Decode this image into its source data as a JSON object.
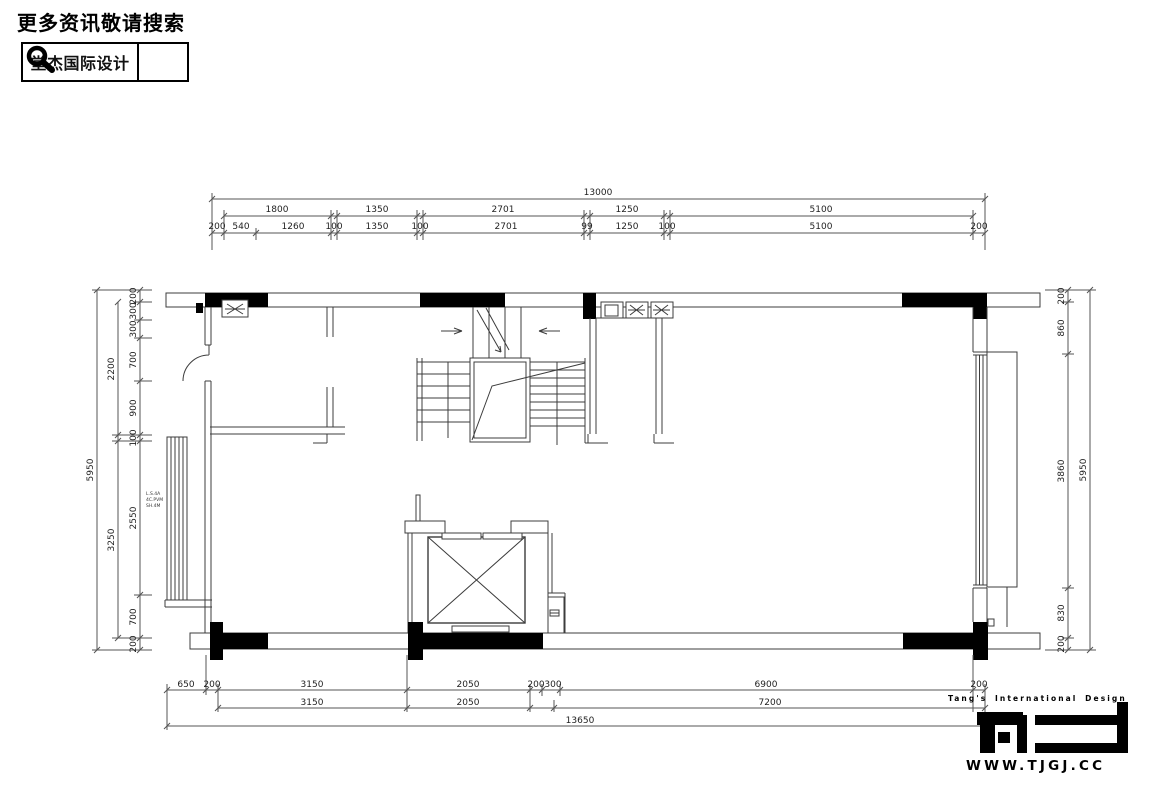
{
  "header": {
    "title": "更多资讯敬请搜索",
    "logo_text": "堂杰国际设计",
    "search_icon": "magnifier-icon"
  },
  "footer": {
    "tagline": "Tang's International Design",
    "logo_name": "TJID logo",
    "website": "WWW.TJGJ.CC"
  },
  "plan": {
    "dims": {
      "top_total": "13000",
      "top_mid": [
        "1800",
        "1350",
        "2701",
        "1250",
        "5100"
      ],
      "top_inner": [
        "200",
        "540",
        "1260",
        "100",
        "1350",
        "100",
        "2701",
        "99",
        "1250",
        "100",
        "5100",
        "200"
      ],
      "left_total": "5950",
      "left_mid": [
        "2200",
        "3250"
      ],
      "left_inner": [
        "200",
        "300",
        "300",
        "700",
        "900",
        "100",
        "2550",
        "700",
        "200"
      ],
      "right_total": "5950",
      "right_inner": [
        "200",
        "860",
        "3860",
        "830",
        "200"
      ],
      "bottom_inner": [
        "650",
        "200",
        "3150",
        "2050",
        "200",
        "300",
        "6900",
        "200"
      ],
      "bottom_mid": [
        "3150",
        "2050",
        "7200"
      ],
      "bottom_total": "13650"
    },
    "notes": [
      "L.S.4A",
      "4C.PVM",
      "SH.4M"
    ]
  },
  "colors": {
    "ink": "#000000",
    "paper": "#ffffff",
    "line": "#3c3c3c"
  }
}
